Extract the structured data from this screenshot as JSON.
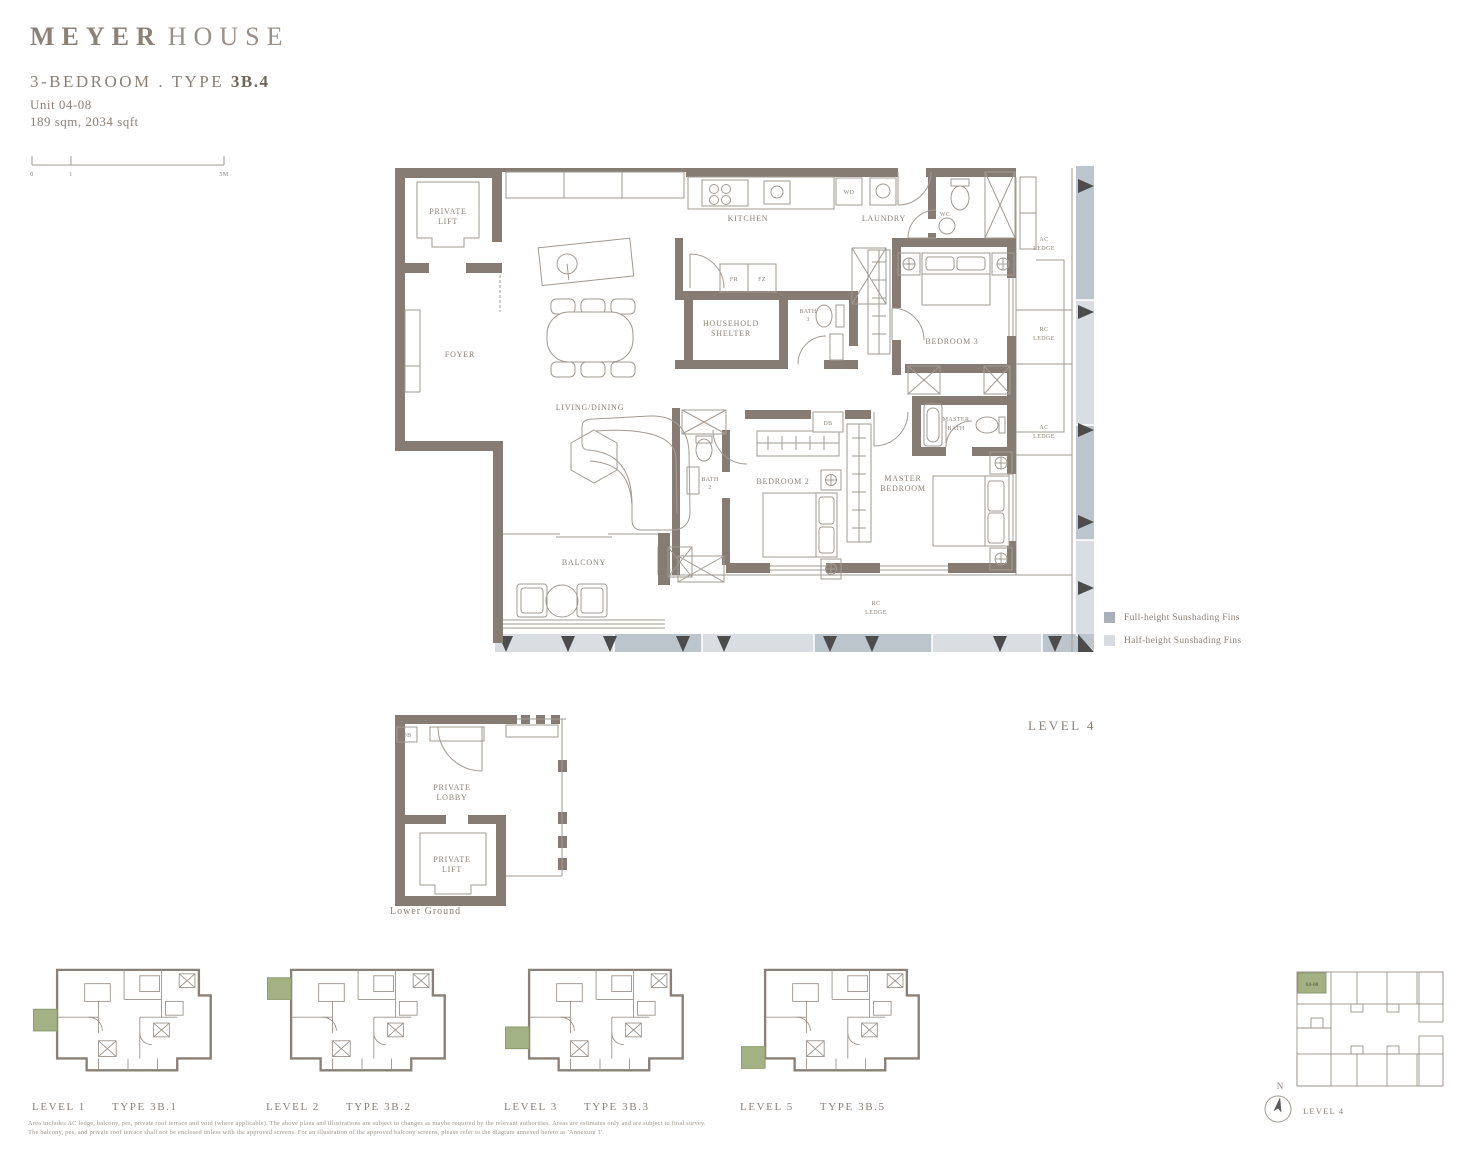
{
  "header": {
    "brand_primary": "MEYER",
    "brand_secondary": "HOUSE",
    "title_prefix": "3-BEDROOM . TYPE",
    "title_bold": "3B.4",
    "unit": "Unit 04-08",
    "area": "189 sqm, 2034 sqft"
  },
  "scale_bar": {
    "t0": "0",
    "t1": "1",
    "t2": "5M"
  },
  "main_plan": {
    "caption": "LEVEL 4",
    "labels": {
      "private_lift": [
        "PRIVATE",
        "LIFT"
      ],
      "foyer": "FOYER",
      "kitchen": "KITCHEN",
      "laundry": "LAUNDRY",
      "wc": "WC",
      "wd": "WD",
      "fr": "FR",
      "fz": "FZ",
      "household": [
        "HOUSEHOLD",
        "SHELTER"
      ],
      "bath3": [
        "BATH",
        "3"
      ],
      "bedroom3": "BEDROOM 3",
      "ac_ledge_top": [
        "AC",
        "LEDGE"
      ],
      "rc_ledge_right": [
        "RC",
        "LEDGE"
      ],
      "master_bath": [
        "MASTER",
        "BATH"
      ],
      "ac_ledge_mid": [
        "AC",
        "LEDGE"
      ],
      "db": "DB",
      "living": "LIVING/DINING",
      "bath2": [
        "BATH",
        "2"
      ],
      "bedroom2": "BEDROOM 2",
      "master_bedroom": [
        "MASTER",
        "BEDROOM"
      ],
      "balcony": "BALCONY",
      "rc_ledge_bottom": [
        "RC",
        "LEDGE"
      ]
    }
  },
  "legend": {
    "items": [
      {
        "label": "Full-height Sunshading Fins",
        "color": "#a9b0ba"
      },
      {
        "label": "Half-height Sunshading Fins",
        "color": "#d8dce0"
      }
    ]
  },
  "lower_ground": {
    "caption": "Lower Ground",
    "labels": {
      "db": "DB",
      "lobby": [
        "PRIVATE",
        "LOBBY"
      ],
      "lift": [
        "PRIVATE",
        "LIFT"
      ]
    }
  },
  "mini_plans": [
    {
      "level": "LEVEL 1",
      "type": "TYPE 3B.1"
    },
    {
      "level": "LEVEL 2",
      "type": "TYPE 3B.2"
    },
    {
      "level": "LEVEL 3",
      "type": "TYPE 3B.3"
    },
    {
      "level": "LEVEL 5",
      "type": "TYPE 3B.5"
    }
  ],
  "key_plan": {
    "unit": "04-08",
    "caption": "LEVEL 4",
    "north": "N"
  },
  "disclaimer": {
    "line1": "Area includes AC ledge, balcony, pes, private roof terrace and void (where applicable). The above plans and illustrations are subject to changes as maybe required by the relevant authorities. Areas are estimates only and are subject to final survey.",
    "line2": "The balcony, pes, and private roof terrace shall not be enclosed unless with the approved screens. For an illustration of the approved balcony screens, please refer to the diagram annexed hereto as 'Annexure 1'."
  },
  "colors": {
    "wall": "#877c74",
    "accent_green": "#a4b184",
    "fin_full": "#bdc5cc",
    "fin_half": "#dadee2"
  }
}
